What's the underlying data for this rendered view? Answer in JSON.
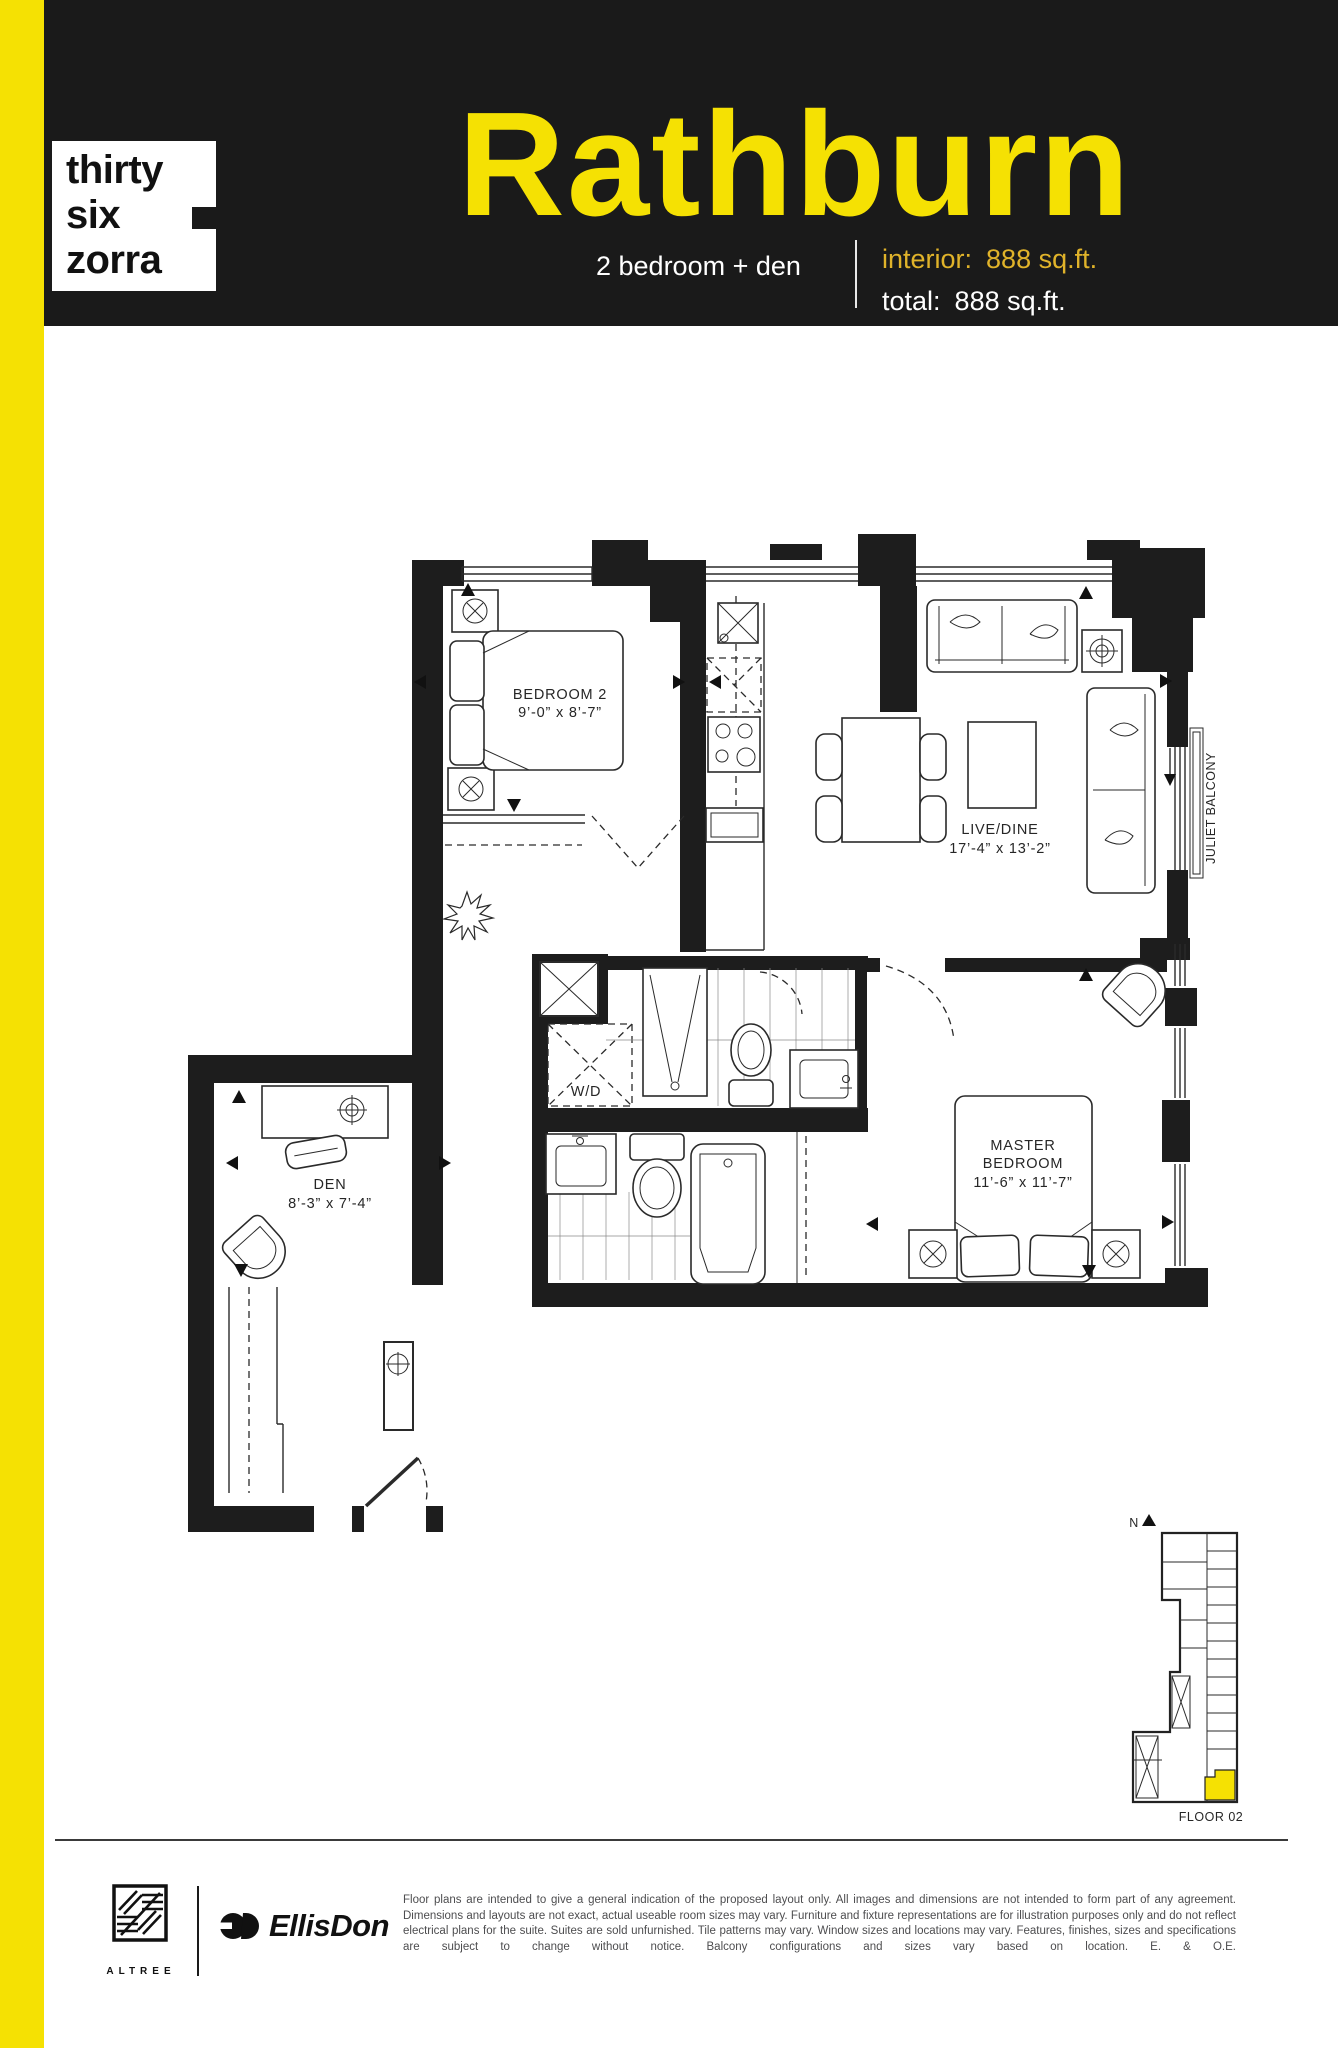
{
  "colors": {
    "accent_yellow": "#f5e103",
    "gold_text": "#e0b32a",
    "header_black": "#1a1a1a",
    "wall_ink": "#1d1d1d",
    "disclaimer_gray": "#4d4d4f"
  },
  "brand": {
    "logo_lines": [
      "thirty",
      "six",
      "zorra"
    ]
  },
  "header": {
    "plan_name": "Rathburn",
    "subtitle": "2 bedroom + den",
    "interior_label": "interior:",
    "interior_value": "888 sq.ft.",
    "total_label": "total:",
    "total_value": "888 sq.ft."
  },
  "plan": {
    "bedroom2": {
      "name": "BEDROOM 2",
      "dims": "9’-0” x 8’-7”"
    },
    "livedine": {
      "name": "LIVE/DINE",
      "dims": "17’-4” x 13’-2”"
    },
    "master": {
      "line1": "MASTER",
      "line2": "BEDROOM",
      "dims": "11’-6” x 11’-7”"
    },
    "den": {
      "name": "DEN",
      "dims": "8’-3” x 7’-4”"
    },
    "wd_label": "W/D",
    "juliet_label": "JULIET BALCONY"
  },
  "keyplan": {
    "north_label": "N",
    "floor_label": "FLOOR 02"
  },
  "footer": {
    "altree_label": "ALTREE",
    "ellisdon_label": "EllisDon",
    "disclaimer": "Floor plans are intended to give a general indication of the proposed layout only. All images and dimensions are not intended to form part of any agreement. Dimensions and layouts are not exact, actual useable room sizes may vary. Furniture and fixture representations are for illustration purposes only and do not reflect electrical plans for the suite. Suites are sold unfurnished. Tile patterns may vary. Window sizes and locations may vary. Features, finishes, sizes and specifications are subject to change without notice. Balcony configurations and sizes vary based on location. E. & O.E."
  }
}
